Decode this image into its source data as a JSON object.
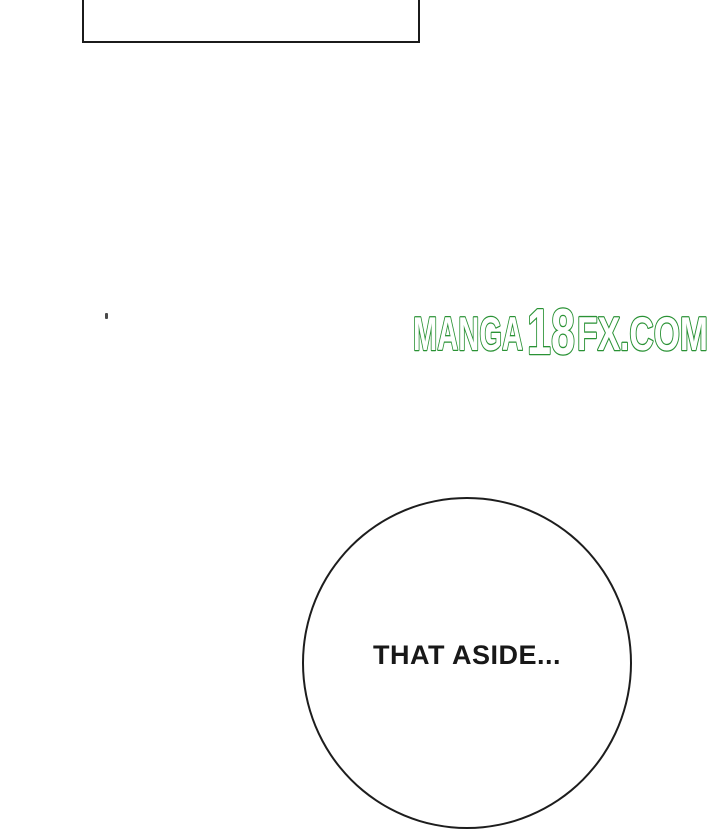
{
  "page": {
    "background_color": "#ffffff",
    "line_color": "#1b1b1b"
  },
  "panel": {
    "description": "empty-rectangular-panel-border-cut-off-at-top"
  },
  "watermark": {
    "part1": "MANGA",
    "part2": "18",
    "part3": "FX.COM",
    "full_text": "MANGA18FX.COM",
    "outline_color": "#2a9235",
    "fill_color": "#ffffff"
  },
  "speech_bubble": {
    "text": "THAT ASIDE...",
    "border_color": "#1d1d1d",
    "fill_color": "#ffffff",
    "text_color": "#181818"
  }
}
